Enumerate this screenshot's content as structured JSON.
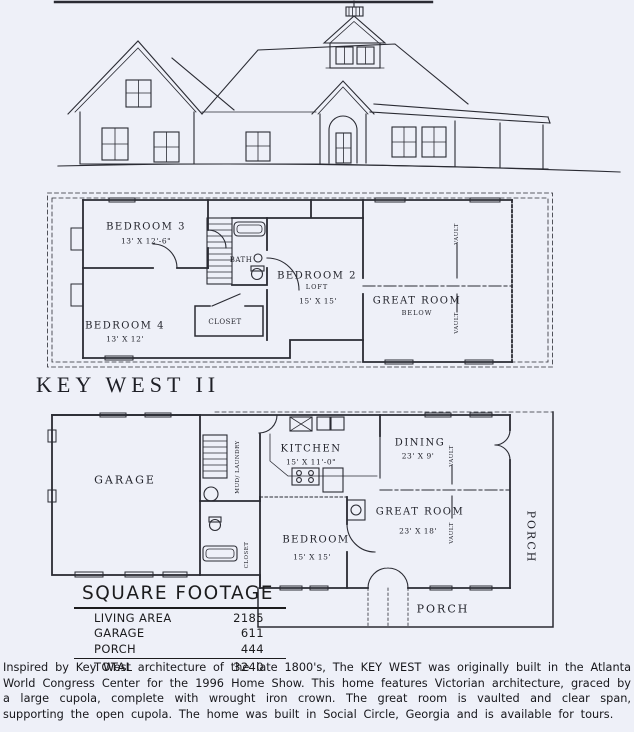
{
  "page": {
    "background": "#eef0f8",
    "ink": "#2a2b33"
  },
  "title": "KEY WEST II",
  "second_floor": {
    "bedroom3": {
      "name": "BEDROOM 3",
      "dims": "13' X 12'-6\""
    },
    "bedroom4": {
      "name": "BEDROOM 4",
      "dims": "13' X 12'"
    },
    "bath": "BATH",
    "closet": "CLOSET",
    "bedroom2": {
      "name": "BEDROOM 2",
      "sub": "LOFT",
      "dims": "15' X 15'"
    },
    "great_room": {
      "name": "GREAT ROOM",
      "sub": "BELOW"
    },
    "vault": "VAULT"
  },
  "first_floor": {
    "garage": "GARAGE",
    "mud_laundry": "MUD/ LAUNDRY",
    "kitchen": {
      "name": "KITCHEN",
      "dims": "15' X 11'-0\""
    },
    "dining": {
      "name": "DINING",
      "dims": "23' X 9'"
    },
    "great_room": {
      "name": "GREAT ROOM",
      "dims": "23' X 18'"
    },
    "bedroom": {
      "name": "BEDROOM",
      "dims": "15' X 15'"
    },
    "closet_small": "CLOSET",
    "porch_bottom": "PORCH",
    "porch_right": "PORCH",
    "vault": "VAULT"
  },
  "square_footage": {
    "title": "SQUARE FOOTAGE",
    "rows": [
      {
        "label": "LIVING AREA",
        "value": "2185"
      },
      {
        "label": "GARAGE",
        "value": "611"
      },
      {
        "label": "PORCH",
        "value": "444"
      }
    ],
    "total": {
      "label": "TOTAL",
      "value": "3240"
    }
  },
  "description": "Inspired by Key West architecture of the late 1800's, The KEY WEST was originally built in the Atlanta World Congress Center for the 1996 Home Show. This home features Victorian architecture, graced by a large cupola, complete with wrought iron crown. The great room is vaulted and clear span, supporting the open cupola. The home was built in Social Circle, Georgia and is available for tours."
}
